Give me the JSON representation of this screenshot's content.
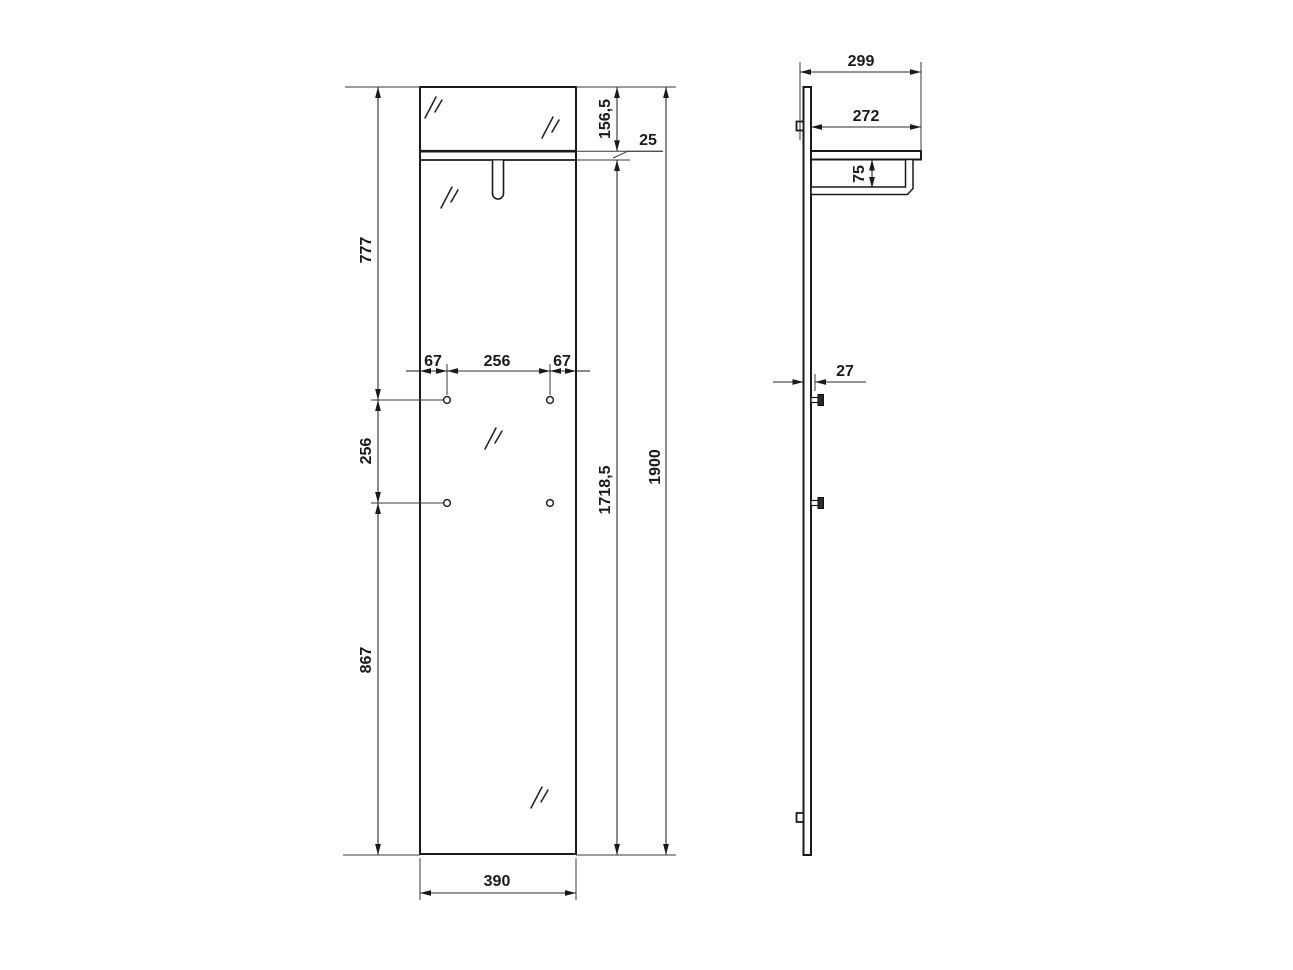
{
  "drawing": {
    "type": "furniture-technical-drawing",
    "views": [
      "front",
      "side"
    ]
  },
  "front_view": {
    "dim_top_section": "777",
    "dim_hole_row_gap": "256",
    "dim_bottom_section": "867",
    "dim_hole_inset_left": "67",
    "dim_hole_spacing": "256",
    "dim_hole_inset_right": "67",
    "dim_top_to_shelf": "156,5",
    "dim_shelf_thickness": "25",
    "dim_below_shelf": "1718,5",
    "dim_total_height": "1900",
    "dim_panel_width": "390"
  },
  "side_view": {
    "dim_total_depth": "299",
    "dim_shelf_depth": "272",
    "dim_rail_offset": "75",
    "dim_panel_thickness": "27"
  },
  "colors": {
    "line": "#1a1a1a",
    "background": "#ffffff"
  }
}
